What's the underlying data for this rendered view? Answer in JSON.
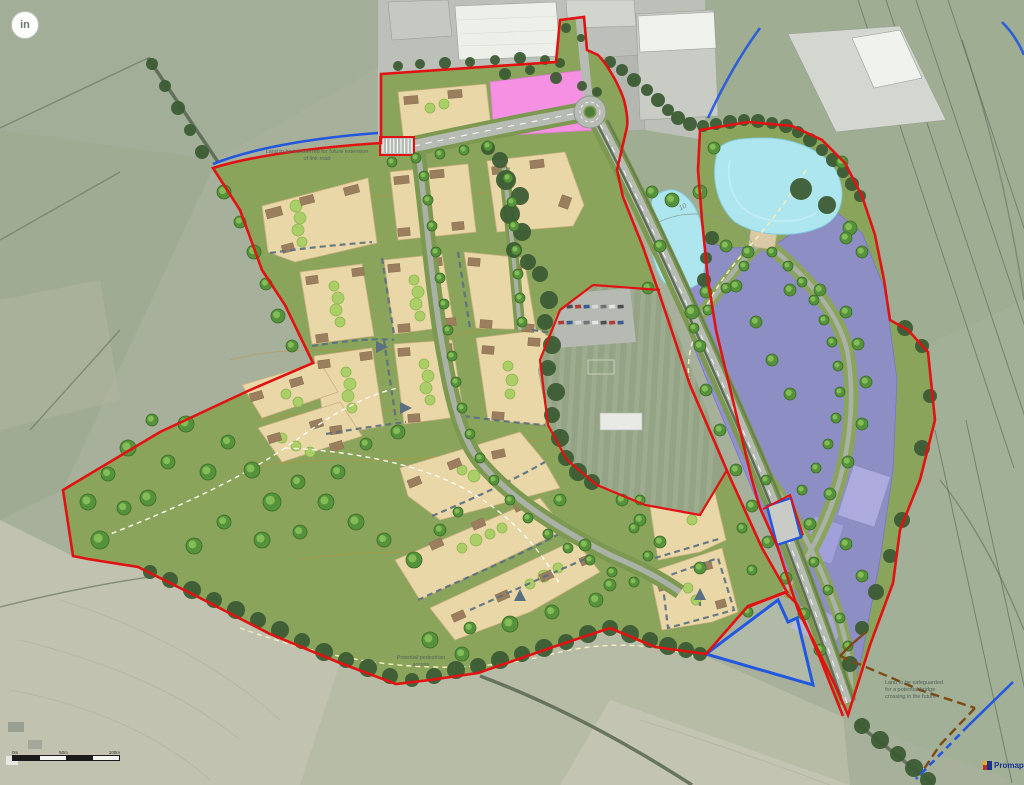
{
  "badge": {
    "text": "in"
  },
  "annotations": {
    "land_transfer": {
      "text": "Land to be transferred for future extension of link road"
    },
    "potential_access": {
      "text": "Potential pedestrian access"
    },
    "safeguarded_crossing": {
      "text": "Land to be safeguarded for a potential bridge crossing in the future"
    },
    "contour_label": {
      "text": "10"
    }
  },
  "scale_bar": {
    "labels": [
      "0m",
      "50m",
      "100m"
    ]
  },
  "logo": {
    "text": "Promap"
  },
  "colors": {
    "site_boundary": "#e11212",
    "secondary_boundary": "#2257e0",
    "safeguarded_route": "#7b4b15",
    "residential_parcel": "#e9d7a8",
    "employment_parcel": "#8e89da",
    "mixed_use": "#f590e2",
    "water": "#aee6ef",
    "open_space": "#8aa45c",
    "road": "#b6bcb4"
  }
}
